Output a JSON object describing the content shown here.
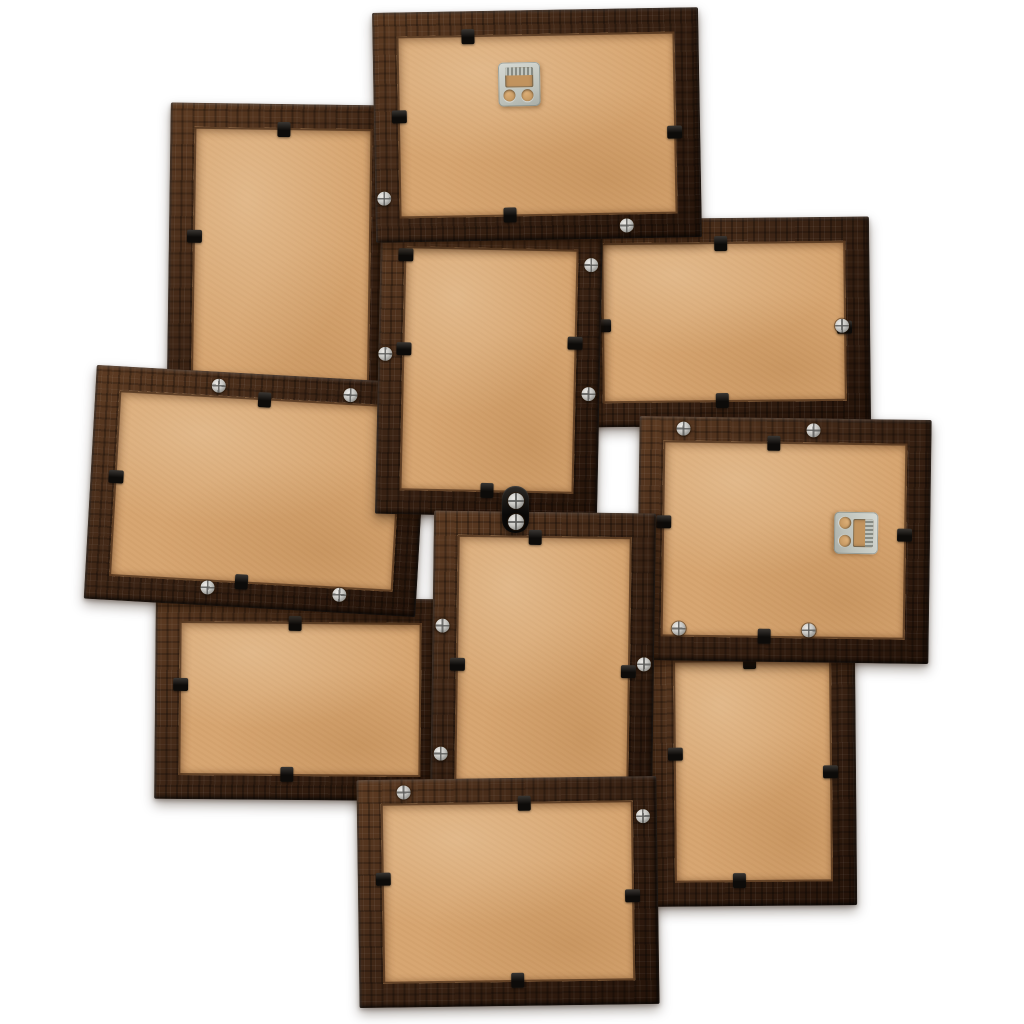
{
  "scene": {
    "title": "Back view of a 10-photo wooden collage picture frame, dark brown, on white background",
    "width": 1024,
    "height": 1024,
    "frame_count": 10,
    "border_px": 24,
    "background": "#ffffff"
  },
  "colors": {
    "wood": "#3a2314",
    "wood_dark": "#241309",
    "wood_light": "#5e3c23",
    "backing": "#d7a672",
    "backing_shadow": "#c1935e",
    "metal": "#c9ccc5",
    "clip": "#14100c"
  },
  "icons": {
    "hanger": "sawtooth-hanger-icon",
    "clip": "retainer-clip",
    "screw": "phillips-screw"
  },
  "frames": [
    {
      "id": "upper-left",
      "orientation": "portrait",
      "x": 168,
      "y": 104,
      "w": 226,
      "h": 404,
      "rot": 0.8,
      "z": 10,
      "hanger": null,
      "clips": [
        {
          "side": "top",
          "frac": 0.5
        },
        {
          "side": "left",
          "frac": 0.33
        }
      ],
      "screws": []
    },
    {
      "id": "top-center",
      "orientation": "landscape",
      "x": 374,
      "y": 10,
      "w": 326,
      "h": 230,
      "rot": -1,
      "z": 30,
      "hanger": {
        "x": 146,
        "y": 74,
        "rot": 0
      },
      "clips": [
        {
          "side": "top",
          "frac": 0.29
        },
        {
          "side": "left",
          "frac": 0.45
        },
        {
          "side": "right",
          "frac": 0.54
        },
        {
          "side": "bottom",
          "frac": 0.41
        }
      ],
      "screws": [
        {
          "x": 9,
          "y": 186
        },
        {
          "x": 251,
          "y": 217
        }
      ]
    },
    {
      "id": "center-upper",
      "orientation": "portrait",
      "x": 378,
      "y": 224,
      "w": 222,
      "h": 292,
      "rot": 1.2,
      "z": 20,
      "hanger": null,
      "clips": [
        {
          "side": "left",
          "frac": 0.11
        },
        {
          "side": "left",
          "frac": 0.43
        },
        {
          "side": "right",
          "frac": 0.4
        },
        {
          "side": "bottom",
          "frac": 0.5
        }
      ],
      "screws": [
        {
          "x": 7,
          "y": 132
        },
        {
          "x": 211,
          "y": 39
        },
        {
          "x": 211,
          "y": 168
        }
      ]
    },
    {
      "id": "upper-right",
      "orientation": "landscape",
      "x": 578,
      "y": 218,
      "w": 292,
      "h": 208,
      "rot": -0.6,
      "z": 12,
      "hanger": null,
      "clips": [
        {
          "side": "top",
          "frac": 0.49
        },
        {
          "side": "left",
          "frac": 0.51
        },
        {
          "side": "right",
          "frac": 0.53
        },
        {
          "side": "bottom",
          "frac": 0.49
        }
      ],
      "screws": [
        {
          "x": 264,
          "y": 109
        }
      ]
    },
    {
      "id": "left-middle",
      "orientation": "landscape",
      "x": 90,
      "y": 374,
      "w": 332,
      "h": 234,
      "rot": 3.2,
      "z": 16,
      "hanger": null,
      "clips": [
        {
          "side": "top",
          "frac": 0.51
        },
        {
          "side": "left",
          "frac": 0.47
        },
        {
          "side": "right",
          "frac": 0.52
        },
        {
          "side": "bottom",
          "frac": 0.47
        }
      ],
      "screws": [
        {
          "x": 123,
          "y": 14
        },
        {
          "x": 255,
          "y": 16
        },
        {
          "x": 123,
          "y": 216
        },
        {
          "x": 255,
          "y": 216
        }
      ]
    },
    {
      "id": "right-middle",
      "orientation": "landscape",
      "x": 638,
      "y": 418,
      "w": 292,
      "h": 244,
      "rot": 0.8,
      "z": 22,
      "hanger": {
        "x": 218,
        "y": 114,
        "rot": 90
      },
      "clips": [
        {
          "side": "top",
          "frac": 0.46
        },
        {
          "side": "left",
          "frac": 0.43
        },
        {
          "side": "right",
          "frac": 0.47
        },
        {
          "side": "bottom",
          "frac": 0.435
        }
      ],
      "screws": [
        {
          "x": 44,
          "y": 12
        },
        {
          "x": 174,
          "y": 12
        },
        {
          "x": 42,
          "y": 212
        },
        {
          "x": 172,
          "y": 212
        }
      ]
    },
    {
      "id": "lower-left",
      "orientation": "landscape",
      "x": 155,
      "y": 598,
      "w": 290,
      "h": 202,
      "rot": 0.5,
      "z": 13,
      "hanger": null,
      "clips": [
        {
          "side": "top",
          "frac": 0.48
        },
        {
          "side": "left",
          "frac": 0.43
        },
        {
          "side": "bottom",
          "frac": 0.455
        }
      ],
      "screws": []
    },
    {
      "id": "center-lower",
      "orientation": "portrait",
      "x": 432,
      "y": 512,
      "w": 222,
      "h": 300,
      "rot": 0.8,
      "z": 26,
      "hanger": null,
      "clips": [
        {
          "side": "top",
          "frac": 0.455
        },
        {
          "side": "left",
          "frac": 0.51
        },
        {
          "side": "right",
          "frac": 0.527
        },
        {
          "side": "bottom",
          "frac": 0.44
        }
      ],
      "screws": [
        {
          "x": 10,
          "y": 115
        },
        {
          "x": 10,
          "y": 243
        },
        {
          "x": 212,
          "y": 151
        }
      ]
    },
    {
      "id": "lower-right",
      "orientation": "portrait",
      "x": 650,
      "y": 636,
      "w": 206,
      "h": 270,
      "rot": -0.5,
      "z": 11,
      "hanger": null,
      "clips": [
        {
          "side": "top",
          "frac": 0.485
        },
        {
          "side": "left",
          "frac": 0.433
        },
        {
          "side": "right",
          "frac": 0.504
        },
        {
          "side": "bottom",
          "frac": 0.427
        }
      ],
      "screws": []
    },
    {
      "id": "bottom-center",
      "orientation": "landscape",
      "x": 358,
      "y": 778,
      "w": 300,
      "h": 228,
      "rot": -0.8,
      "z": 32,
      "hanger": null,
      "clips": [
        {
          "side": "top",
          "frac": 0.557
        },
        {
          "side": "left",
          "frac": 0.434
        },
        {
          "side": "right",
          "frac": 0.52
        },
        {
          "side": "bottom",
          "frac": 0.527
        }
      ],
      "screws": [
        {
          "x": 47,
          "y": 13
        },
        {
          "x": 286,
          "y": 40
        }
      ]
    }
  ],
  "connector": {
    "x": 502,
    "y": 486,
    "w": 27,
    "h": 47,
    "z": 40,
    "screws": [
      {
        "x": 14,
        "y": 15
      },
      {
        "x": 14,
        "y": 36
      }
    ]
  }
}
